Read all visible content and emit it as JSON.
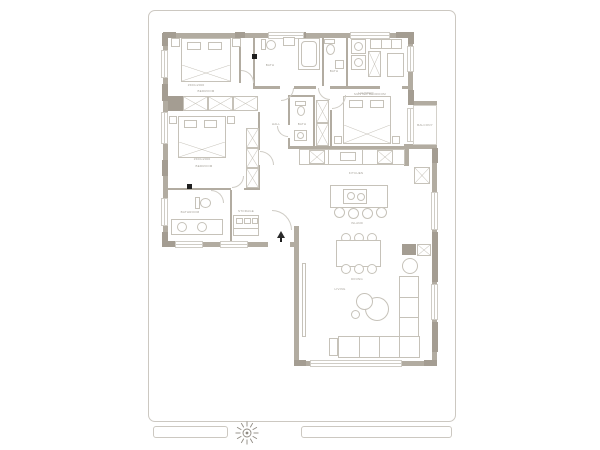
{
  "plan": {
    "title": "apartment-floor-plan",
    "colors": {
      "wall": "#b2aca1",
      "structural_column": "#a49d92",
      "furniture_line": "#c6c2b9",
      "entry_marker": "#2a2a2a",
      "site_border": "#ccc8c1"
    },
    "labels": {
      "bedroom1": "BEDROOM",
      "bedroom1_size": "1500x2000",
      "bedroom2": "BEDROOM",
      "bedroom2_size": "1500x2000",
      "master": "MASTER BEDROOM",
      "bath1": "BATH",
      "bath2": "BATH",
      "bath3": "BATH",
      "bathroom_bl": "BATHROOM",
      "laundry": "LAUNDRY",
      "hall": "HALL",
      "storage": "STORAGE",
      "kitchen": "KITCHEN",
      "island": "ISLAND",
      "dining": "DINING",
      "living": "LIVING",
      "balcony": "BALCONY"
    },
    "icons": {
      "compass": "compass-rose",
      "entry": "entry-arrow"
    }
  }
}
